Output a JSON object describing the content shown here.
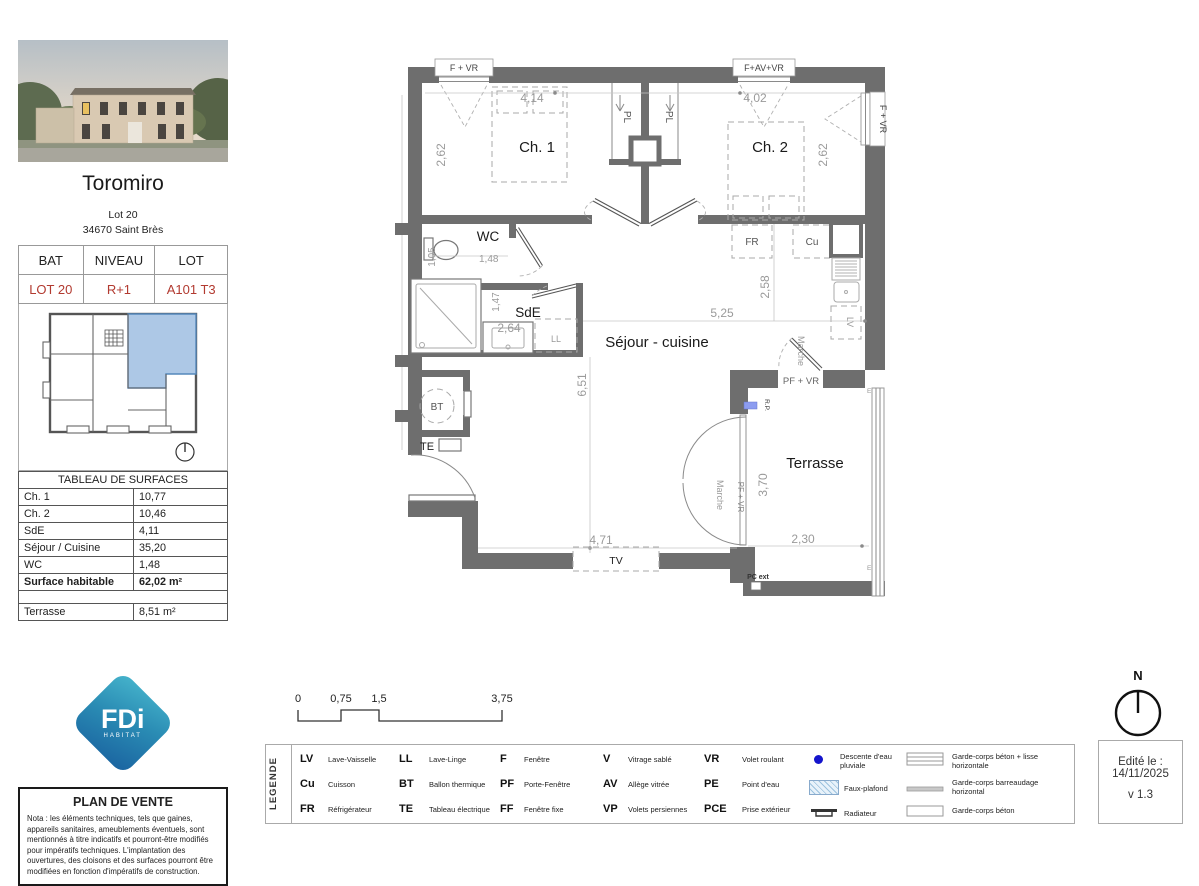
{
  "colors": {
    "accent_red": "#b23a30",
    "wall_gray": "#6e6e6e",
    "dimension_gray": "#9a9a9a",
    "keyplan_highlight_blue": "#adc8e6",
    "logo_teal": "#3fb0c9",
    "logo_blue": "#1a63a0",
    "downpipe_blue": "#1414cc",
    "rp_blue": "#8c9cf0"
  },
  "sidebar": {
    "title": "Toromiro",
    "lot": "Lot 20",
    "city": "34670 Saint Brès",
    "unit_table": {
      "col1_header": "BAT",
      "col2_header": "NIVEAU",
      "col3_header": "LOT",
      "col1_value": "LOT 20",
      "col2_value": "R+1",
      "col3_value": "A101 T3"
    },
    "surfaces": {
      "title": "TABLEAU DE SURFACES",
      "rows": [
        {
          "label": "Ch. 1",
          "value": "10,77"
        },
        {
          "label": "Ch. 2",
          "value": "10,46"
        },
        {
          "label": "SdE",
          "value": "4,11"
        },
        {
          "label": "Séjour / Cuisine",
          "value": "35,20"
        },
        {
          "label": "WC",
          "value": "1,48"
        }
      ],
      "total": {
        "label": "Surface habitable",
        "value": "62,02 m²"
      },
      "terrace": {
        "label": "Terrasse",
        "value": "8,51 m²"
      }
    },
    "logo": {
      "text": "FDi",
      "subtext": "HABITAT"
    },
    "notice": {
      "title": "PLAN DE VENTE",
      "body": "Nota : les éléments techniques, tels que gaines, appareils sanitaires, ameublements éventuels, sont mentionnés à titre indicatifs et pourront-être modifiés pour impératifs techniques. L'implantation des ouvertures, des cloisons et des surfaces pourront être modifiées en fonction d'impératifs de construction."
    }
  },
  "plan": {
    "rooms": {
      "ch1": "Ch. 1",
      "ch2": "Ch. 2",
      "wc": "WC",
      "sde": "SdE",
      "sejour": "Séjour - cuisine",
      "terrasse": "Terrasse"
    },
    "dims": {
      "ch1_width": "4,14",
      "ch2_width": "4,02",
      "ch1_depth": "2,62",
      "ch2_depth": "2,62",
      "wc_width": "1,48",
      "wc_depth": "1,05",
      "sde_depth": "1,47",
      "sde_width": "2,64",
      "sejour_depth": "6,51",
      "sejour_width": "5,25",
      "kitchen_depth": "2,58",
      "sejour_bottom_width": "4,71",
      "terrasse_depth": "3,70",
      "terrasse_width": "2,30"
    },
    "openings": {
      "window_top_left": "F + VR",
      "window_top_right": "F+AV+VR",
      "window_right": "F + VR",
      "door_kitchen_label": "PF + VR",
      "door_terrace_label": "PF + VR"
    },
    "tags": {
      "pl": "PL",
      "ll": "LL",
      "bt": "BT",
      "te": "TE",
      "tv": "TV",
      "fr": "FR",
      "cu": "Cu",
      "lv": "LV",
      "rp": "R.P.",
      "pc_ext": "PC ext",
      "marche": "Marche",
      "e": "E"
    }
  },
  "scalebar": {
    "t0": "0",
    "t1": "0,75",
    "t2": "1,5",
    "t3": "3,75"
  },
  "legend": {
    "title": "LEGENDE",
    "items": [
      {
        "abbr": "LV",
        "label": "Lave-Vaisselle"
      },
      {
        "abbr": "Cu",
        "label": "Cuisson"
      },
      {
        "abbr": "FR",
        "label": "Réfrigérateur"
      },
      {
        "abbr": "LL",
        "label": "Lave-Linge"
      },
      {
        "abbr": "BT",
        "label": "Ballon thermique"
      },
      {
        "abbr": "TE",
        "label": "Tableau électrique"
      },
      {
        "abbr": "F",
        "label": "Fenêtre"
      },
      {
        "abbr": "PF",
        "label": "Porte-Fenêtre"
      },
      {
        "abbr": "FF",
        "label": "Fenêtre fixe"
      },
      {
        "abbr": "V",
        "label": "Vitrage sablé"
      },
      {
        "abbr": "AV",
        "label": "Allège vitrée"
      },
      {
        "abbr": "VP",
        "label": "Volets persiennes"
      },
      {
        "abbr": "VR",
        "label": "Volet roulant"
      },
      {
        "abbr": "PE",
        "label": "Point d'eau"
      },
      {
        "abbr": "PCE",
        "label": "Prise extérieur"
      }
    ],
    "symbols": [
      {
        "name": "rain-water-downpipe",
        "label": "Descente d'eau pluviale"
      },
      {
        "name": "false-ceiling",
        "label": "Faux-plafond"
      },
      {
        "name": "radiator",
        "label": "Radiateur"
      },
      {
        "name": "concrete-guardrail-horizontal-rail",
        "label": "Garde-corps béton + lisse horizontale"
      },
      {
        "name": "horizontal-bars-guardrail",
        "label": "Garde-corps barreaudage horizontal"
      },
      {
        "name": "concrete-guardrail",
        "label": "Garde-corps béton"
      }
    ]
  },
  "footer": {
    "edited_label": "Edité le :",
    "edited_date": "14/11/2025",
    "version": "v 1.3",
    "north": "N"
  }
}
